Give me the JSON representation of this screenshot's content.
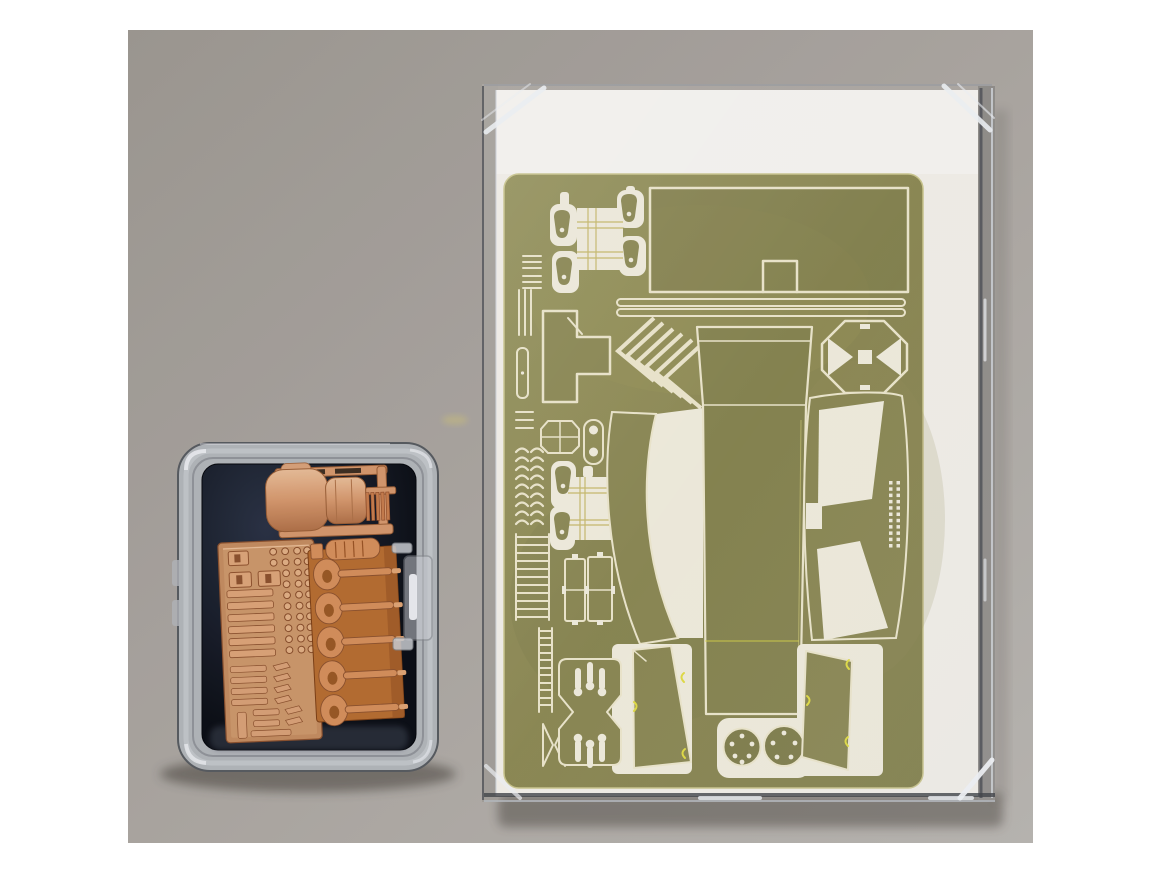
{
  "image": {
    "type": "photograph",
    "subject": "Model kit aftermarket detail set: olive-tinted photo-etched brass fret packed in a clear sleeve over a white backing card, next to a small latched clear plastic box holding orange resin parts on dark navy foam",
    "background": "plain gray studio surface with soft shadows"
  },
  "package": {
    "name": "photo-etch-set-package",
    "sleeve": "clear plastic sleeve with beveled shiny corners",
    "card": "white backing card",
    "fret": {
      "finish": "olive-tinted etched brass",
      "parts": [
        "top radiator grille with four bell caps",
        "large hull plate with rectangular notch",
        "two long fender strips",
        "comb clips",
        "triple strip blanks",
        "slotted narrow bar",
        "equals-sign blanks",
        "curved link set",
        "ladder strip",
        "track ladder strip",
        "bow-tie bracket",
        "T-shaped stowage plate",
        "chevron louvre set",
        "octagonal cap",
        "oval capsule plate",
        "second radiator grille with four bell caps",
        "twin hatch plates",
        "left curved fender with crescent cutout",
        "central hull roof panel",
        "diamond access cover",
        "right curved fender with two window cutouts",
        "rivet zipper strip",
        "cross mount with keyhole slots",
        "two drilled discs",
        "left door panel with yellow clip marks",
        "right door panel with yellow clip marks"
      ]
    }
  },
  "box": {
    "name": "resin-parts-box",
    "material": "clear polystyrene box with right-side clasp",
    "liner": "dark navy foam pad",
    "parts": [
      "exhaust muffler with mounting cage and finned end",
      "flat tool plate with rows of tools, clamps and knobs",
      "carrier sprue with five loop shackles and ribbed cylinder"
    ]
  },
  "colors": {
    "page_margin": "#ffffff",
    "photo_bg_a": "#a09b95",
    "photo_bg_b": "#bcb9b5",
    "card_white": "#f6f4ee",
    "card_bright": "#fbfaf6",
    "sleeve_edge_dark": "#54575d",
    "sleeve_edge_light": "#d7dce2",
    "sleeve_glint": "#f3f7fb",
    "fret_base_a": "#959259",
    "fret_base_b": "#83814b",
    "fret_edge": "#cdc98f",
    "fret_olive_part": "#8a8851",
    "fret_olive_deep": "#7e7c48",
    "etch_cream": "#f0ebd0",
    "cutout_cream": "#f4f1e1",
    "lattice_gold": "#c9bc6a",
    "clip_yellow": "#e4e041",
    "scratch_gold": "#c8c183",
    "shadow": "#3c3933",
    "box_rim": "#b5b9be",
    "box_rim_line": "#595d63",
    "box_rim_hl": "#eff2f6",
    "foam_a": "#2b3346",
    "foam_b": "#0c0f17",
    "latch_fill": "#ced2d8",
    "latch_slot": "#f3f6fa",
    "resin_base": "#d89a6f",
    "resin_light": "#ecc19c",
    "resin_dark": "#b3734a",
    "resin_deep": "#8e5330",
    "resin_outline": "#9c6038",
    "resin_carrier": "#b96f33",
    "resin_carrier_dark": "#7e4117",
    "resin_loop": "#d8925e",
    "fin_orange": "#c97f4f",
    "fin_gap": "#8e4a28",
    "smudge_yellow": "#d8c878"
  }
}
